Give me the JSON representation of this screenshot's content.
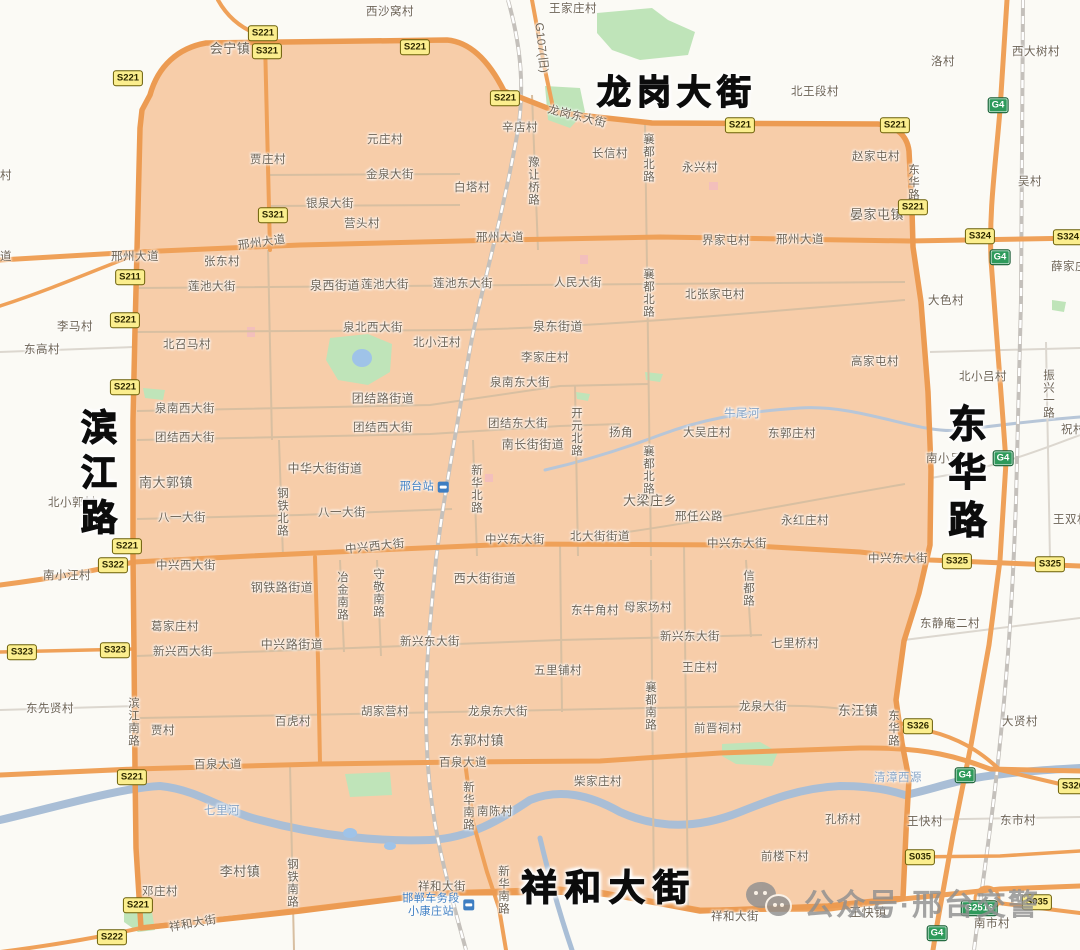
{
  "app": {
    "title": "邢台市区限行区域地图"
  },
  "colors": {
    "zone_fill": "#F7CDA9",
    "zone_border": "#EC9B52",
    "road_major": "#EFA159",
    "road_minor_inside": "#D8BFA1",
    "road_minor_outside": "#DCD7CF",
    "railway": "#C4C0BB",
    "water": "#A9BED6",
    "greenery": "#BFE4B9",
    "badge_yellow": "#FBEE8E",
    "badge_green": "#2E9A5B",
    "label_text": "#6E6456",
    "water_label": "#87A4C5",
    "station_label": "#3E7EC2",
    "title_text": "#0C0C0C",
    "watermark": "#909090",
    "background": "#FBFAF5"
  },
  "map": {
    "big_titles": [
      {
        "t": "龙岗大街",
        "x": 677,
        "y": 93,
        "s": 34,
        "ls": 6,
        "v": 0
      },
      {
        "t": "滨江路",
        "x": 96,
        "y": 476,
        "s": 36,
        "ls": 9,
        "v": 1
      },
      {
        "t": "东华路",
        "x": 963,
        "y": 476,
        "s": 38,
        "ls": 10,
        "v": 1
      },
      {
        "t": "祥和大街",
        "x": 609,
        "y": 888,
        "s": 36,
        "ls": 8,
        "v": 0
      }
    ],
    "streets": [
      {
        "t": "邢州大道",
        "x": 135,
        "y": 257
      },
      {
        "t": "邢州大道",
        "x": 262,
        "y": 243,
        "r": -8
      },
      {
        "t": "邢州大道",
        "x": 500,
        "y": 238
      },
      {
        "t": "邢州大道",
        "x": 800,
        "y": 240
      },
      {
        "t": "龙岗东大街",
        "x": 577,
        "y": 117,
        "r": 14
      },
      {
        "t": "金泉大街",
        "x": 390,
        "y": 175
      },
      {
        "t": "银泉大街",
        "x": 330,
        "y": 204
      },
      {
        "t": "莲池大街",
        "x": 212,
        "y": 287
      },
      {
        "t": "莲池大街",
        "x": 385,
        "y": 285
      },
      {
        "t": "莲池东大街",
        "x": 463,
        "y": 284
      },
      {
        "t": "人民大街",
        "x": 578,
        "y": 283
      },
      {
        "t": "泉北西大街",
        "x": 373,
        "y": 328
      },
      {
        "t": "泉南西大街",
        "x": 185,
        "y": 409
      },
      {
        "t": "泉南东大街",
        "x": 520,
        "y": 383
      },
      {
        "t": "团结西大街",
        "x": 185,
        "y": 438
      },
      {
        "t": "团结西大街",
        "x": 383,
        "y": 428
      },
      {
        "t": "团结东大街",
        "x": 518,
        "y": 424
      },
      {
        "t": "八一大街",
        "x": 182,
        "y": 518
      },
      {
        "t": "八一大街",
        "x": 342,
        "y": 513
      },
      {
        "t": "中兴西大街",
        "x": 375,
        "y": 547,
        "r": -6
      },
      {
        "t": "中兴西大街",
        "x": 186,
        "y": 566
      },
      {
        "t": "中兴东大街",
        "x": 515,
        "y": 540
      },
      {
        "t": "中兴东大街",
        "x": 737,
        "y": 544
      },
      {
        "t": "中兴东大街",
        "x": 898,
        "y": 559
      },
      {
        "t": "新兴西大街",
        "x": 183,
        "y": 652
      },
      {
        "t": "新兴东大街",
        "x": 430,
        "y": 642
      },
      {
        "t": "新兴东大街",
        "x": 690,
        "y": 637
      },
      {
        "t": "龙泉东大街",
        "x": 498,
        "y": 712
      },
      {
        "t": "龙泉大街",
        "x": 763,
        "y": 707
      },
      {
        "t": "百泉大道",
        "x": 218,
        "y": 765
      },
      {
        "t": "百泉大道",
        "x": 463,
        "y": 763
      },
      {
        "t": "祥和大街",
        "x": 442,
        "y": 887
      },
      {
        "t": "祥和大街",
        "x": 193,
        "y": 924,
        "r": -10
      },
      {
        "t": "祥和大街",
        "x": 735,
        "y": 917
      },
      {
        "t": "邢任公路",
        "x": 699,
        "y": 517
      },
      {
        "t": "北大街街道",
        "x": 600,
        "y": 537
      },
      {
        "t": "G107(旧)",
        "x": 541,
        "y": 48,
        "r": 84
      },
      {
        "t": "襄都北路",
        "x": 648,
        "y": 158,
        "v": 1
      },
      {
        "t": "襄都北路",
        "x": 648,
        "y": 293,
        "v": 1
      },
      {
        "t": "襄都北路",
        "x": 648,
        "y": 470,
        "v": 1
      },
      {
        "t": "襄都南路",
        "x": 650,
        "y": 706,
        "v": 1
      },
      {
        "t": "豫让桥路",
        "x": 533,
        "y": 181,
        "v": 1
      },
      {
        "t": "东华路",
        "x": 913,
        "y": 182,
        "v": 1
      },
      {
        "t": "东华路",
        "x": 893,
        "y": 728,
        "v": 1
      },
      {
        "t": "钢铁北路",
        "x": 282,
        "y": 512,
        "v": 1
      },
      {
        "t": "钢铁南路",
        "x": 292,
        "y": 883,
        "v": 1
      },
      {
        "t": "新华北路",
        "x": 476,
        "y": 489,
        "v": 1
      },
      {
        "t": "新华南路",
        "x": 468,
        "y": 806,
        "v": 1
      },
      {
        "t": "新华南路",
        "x": 503,
        "y": 890,
        "v": 1
      },
      {
        "t": "开元北路",
        "x": 576,
        "y": 432,
        "v": 1
      },
      {
        "t": "冶金南路",
        "x": 342,
        "y": 596,
        "v": 1
      },
      {
        "t": "守敬南路",
        "x": 378,
        "y": 593,
        "v": 1
      },
      {
        "t": "信都路",
        "x": 748,
        "y": 588,
        "v": 1
      },
      {
        "t": "滨江南路",
        "x": 133,
        "y": 722,
        "v": 1
      },
      {
        "t": "振兴一路",
        "x": 1048,
        "y": 394,
        "v": 1
      }
    ],
    "places": [
      {
        "t": "西沙窝村",
        "x": 390,
        "y": 12
      },
      {
        "t": "王家庄村",
        "x": 573,
        "y": 9
      },
      {
        "t": "会宁镇",
        "x": 230,
        "y": 49,
        "s": 13
      },
      {
        "t": "北王段村",
        "x": 815,
        "y": 92
      },
      {
        "t": "洛村",
        "x": 943,
        "y": 62
      },
      {
        "t": "西大树村",
        "x": 1036,
        "y": 52
      },
      {
        "t": "元庄村",
        "x": 385,
        "y": 140
      },
      {
        "t": "贾庄村",
        "x": 268,
        "y": 160
      },
      {
        "t": "辛店村",
        "x": 520,
        "y": 128
      },
      {
        "t": "白塔村",
        "x": 472,
        "y": 188
      },
      {
        "t": "长信村",
        "x": 610,
        "y": 154
      },
      {
        "t": "永兴村",
        "x": 700,
        "y": 168
      },
      {
        "t": "赵家屯村",
        "x": 876,
        "y": 157
      },
      {
        "t": "吴村",
        "x": 1030,
        "y": 182
      },
      {
        "t": "晏家屯镇",
        "x": 877,
        "y": 215,
        "s": 13
      },
      {
        "t": "营头村",
        "x": 362,
        "y": 224
      },
      {
        "t": "张东村",
        "x": 222,
        "y": 262
      },
      {
        "t": "界家屯村",
        "x": 726,
        "y": 241
      },
      {
        "t": "薛家庄",
        "x": 1069,
        "y": 267
      },
      {
        "t": "北张家屯村",
        "x": 715,
        "y": 295
      },
      {
        "t": "大色村",
        "x": 946,
        "y": 301
      },
      {
        "t": "李马村",
        "x": 75,
        "y": 327
      },
      {
        "t": "东高村",
        "x": 42,
        "y": 350
      },
      {
        "t": "泉西街道",
        "x": 335,
        "y": 286,
        "s": 12
      },
      {
        "t": "泉东街道",
        "x": 558,
        "y": 327,
        "s": 12
      },
      {
        "t": "北小汪村",
        "x": 437,
        "y": 343
      },
      {
        "t": "北召马村",
        "x": 187,
        "y": 345
      },
      {
        "t": "李家庄村",
        "x": 545,
        "y": 358
      },
      {
        "t": "高家屯村",
        "x": 875,
        "y": 362
      },
      {
        "t": "北小吕村",
        "x": 983,
        "y": 377
      },
      {
        "t": "团结路街道",
        "x": 383,
        "y": 399,
        "s": 12
      },
      {
        "t": "扬角",
        "x": 621,
        "y": 433
      },
      {
        "t": "大吴庄村",
        "x": 707,
        "y": 433
      },
      {
        "t": "东郭庄村",
        "x": 792,
        "y": 434
      },
      {
        "t": "祝村",
        "x": 1073,
        "y": 430
      },
      {
        "t": "南长街街道",
        "x": 533,
        "y": 445,
        "s": 12
      },
      {
        "t": "中华大街街道",
        "x": 325,
        "y": 469,
        "s": 12
      },
      {
        "t": "南大郭镇",
        "x": 166,
        "y": 483,
        "s": 13
      },
      {
        "t": "北小郭村",
        "x": 72,
        "y": 503
      },
      {
        "t": "大梁庄乡",
        "x": 650,
        "y": 501,
        "s": 13
      },
      {
        "t": "永红庄村",
        "x": 805,
        "y": 521
      },
      {
        "t": "南小吕村",
        "x": 950,
        "y": 459
      },
      {
        "t": "王双村",
        "x": 1071,
        "y": 520
      },
      {
        "t": "南小汪村",
        "x": 67,
        "y": 576
      },
      {
        "t": "钢铁路街道",
        "x": 282,
        "y": 588,
        "s": 12
      },
      {
        "t": "西大街街道",
        "x": 485,
        "y": 579,
        "s": 12
      },
      {
        "t": "葛家庄村",
        "x": 175,
        "y": 627
      },
      {
        "t": "中兴路街道",
        "x": 292,
        "y": 645,
        "s": 12
      },
      {
        "t": "东牛角村",
        "x": 595,
        "y": 611
      },
      {
        "t": "母家场村",
        "x": 648,
        "y": 608
      },
      {
        "t": "东静庵二村",
        "x": 950,
        "y": 624
      },
      {
        "t": "五里铺村",
        "x": 558,
        "y": 671
      },
      {
        "t": "王庄村",
        "x": 700,
        "y": 668
      },
      {
        "t": "七里桥村",
        "x": 795,
        "y": 644
      },
      {
        "t": "东先贤村",
        "x": 50,
        "y": 709
      },
      {
        "t": "贾村",
        "x": 163,
        "y": 731
      },
      {
        "t": "百虎村",
        "x": 293,
        "y": 722
      },
      {
        "t": "胡家营村",
        "x": 385,
        "y": 712
      },
      {
        "t": "东汪镇",
        "x": 858,
        "y": 711,
        "s": 13
      },
      {
        "t": "前晋祠村",
        "x": 718,
        "y": 729
      },
      {
        "t": "东郭村镇",
        "x": 477,
        "y": 741,
        "s": 13
      },
      {
        "t": "大贤村",
        "x": 1020,
        "y": 722
      },
      {
        "t": "柴家庄村",
        "x": 598,
        "y": 782
      },
      {
        "t": "南陈村",
        "x": 495,
        "y": 812
      },
      {
        "t": "李村镇",
        "x": 240,
        "y": 872,
        "s": 13
      },
      {
        "t": "邓庄村",
        "x": 160,
        "y": 892
      },
      {
        "t": "孔桥村",
        "x": 843,
        "y": 820
      },
      {
        "t": "王快村",
        "x": 925,
        "y": 822
      },
      {
        "t": "东市村",
        "x": 1018,
        "y": 821
      },
      {
        "t": "前楼下村",
        "x": 785,
        "y": 857
      },
      {
        "t": "王快镇",
        "x": 868,
        "y": 913,
        "s": 12
      },
      {
        "t": "南市村",
        "x": 992,
        "y": 924
      },
      {
        "t": "村",
        "x": 6,
        "y": 176
      },
      {
        "t": "道",
        "x": 6,
        "y": 257
      }
    ],
    "waters": [
      {
        "t": "牛尾河",
        "x": 742,
        "y": 414
      },
      {
        "t": "七里河",
        "x": 222,
        "y": 811
      },
      {
        "t": "清漳西源",
        "x": 898,
        "y": 778
      }
    ],
    "stations": [
      {
        "lines": [
          "邢台站"
        ],
        "x": 424,
        "y": 487
      },
      {
        "lines": [
          "邯郸车务段",
          "小康庄站"
        ],
        "x": 438,
        "y": 905
      }
    ],
    "route_badges": [
      {
        "code": "S221",
        "x": 263,
        "y": 33,
        "k": "s"
      },
      {
        "code": "S321",
        "x": 267,
        "y": 51,
        "k": "s"
      },
      {
        "code": "S221",
        "x": 415,
        "y": 47,
        "k": "s"
      },
      {
        "code": "S221",
        "x": 128,
        "y": 78,
        "k": "s"
      },
      {
        "code": "S221",
        "x": 505,
        "y": 98,
        "k": "s"
      },
      {
        "code": "S221",
        "x": 740,
        "y": 125,
        "k": "s"
      },
      {
        "code": "S221",
        "x": 895,
        "y": 125,
        "k": "s"
      },
      {
        "code": "S221",
        "x": 913,
        "y": 207,
        "k": "s"
      },
      {
        "code": "S321",
        "x": 273,
        "y": 215,
        "k": "s"
      },
      {
        "code": "S324",
        "x": 980,
        "y": 236,
        "k": "s"
      },
      {
        "code": "S324",
        "x": 1068,
        "y": 237,
        "k": "s"
      },
      {
        "code": "S211",
        "x": 130,
        "y": 277,
        "k": "s"
      },
      {
        "code": "S221",
        "x": 125,
        "y": 320,
        "k": "s"
      },
      {
        "code": "S221",
        "x": 125,
        "y": 387,
        "k": "s"
      },
      {
        "code": "S221",
        "x": 127,
        "y": 546,
        "k": "s"
      },
      {
        "code": "S322",
        "x": 113,
        "y": 565,
        "k": "s"
      },
      {
        "code": "S325",
        "x": 957,
        "y": 561,
        "k": "s"
      },
      {
        "code": "S325",
        "x": 1050,
        "y": 564,
        "k": "s"
      },
      {
        "code": "S323",
        "x": 22,
        "y": 652,
        "k": "s"
      },
      {
        "code": "S323",
        "x": 115,
        "y": 650,
        "k": "s"
      },
      {
        "code": "S326",
        "x": 918,
        "y": 726,
        "k": "s"
      },
      {
        "code": "S326",
        "x": 1073,
        "y": 786,
        "k": "s"
      },
      {
        "code": "S221",
        "x": 132,
        "y": 777,
        "k": "s"
      },
      {
        "code": "S035",
        "x": 920,
        "y": 857,
        "k": "s"
      },
      {
        "code": "S035",
        "x": 1037,
        "y": 902,
        "k": "s"
      },
      {
        "code": "S221",
        "x": 138,
        "y": 905,
        "k": "s"
      },
      {
        "code": "S222",
        "x": 112,
        "y": 937,
        "k": "s"
      },
      {
        "code": "G4",
        "x": 998,
        "y": 105,
        "k": "g"
      },
      {
        "code": "G4",
        "x": 1000,
        "y": 257,
        "k": "g"
      },
      {
        "code": "G4",
        "x": 1003,
        "y": 458,
        "k": "g"
      },
      {
        "code": "G4",
        "x": 965,
        "y": 775,
        "k": "g"
      },
      {
        "code": "G4",
        "x": 937,
        "y": 933,
        "k": "g"
      },
      {
        "code": "G2516",
        "x": 979,
        "y": 908,
        "k": "g"
      }
    ]
  },
  "watermark": {
    "text": "公众号·邢台交警",
    "icon": "wechat-icon"
  }
}
